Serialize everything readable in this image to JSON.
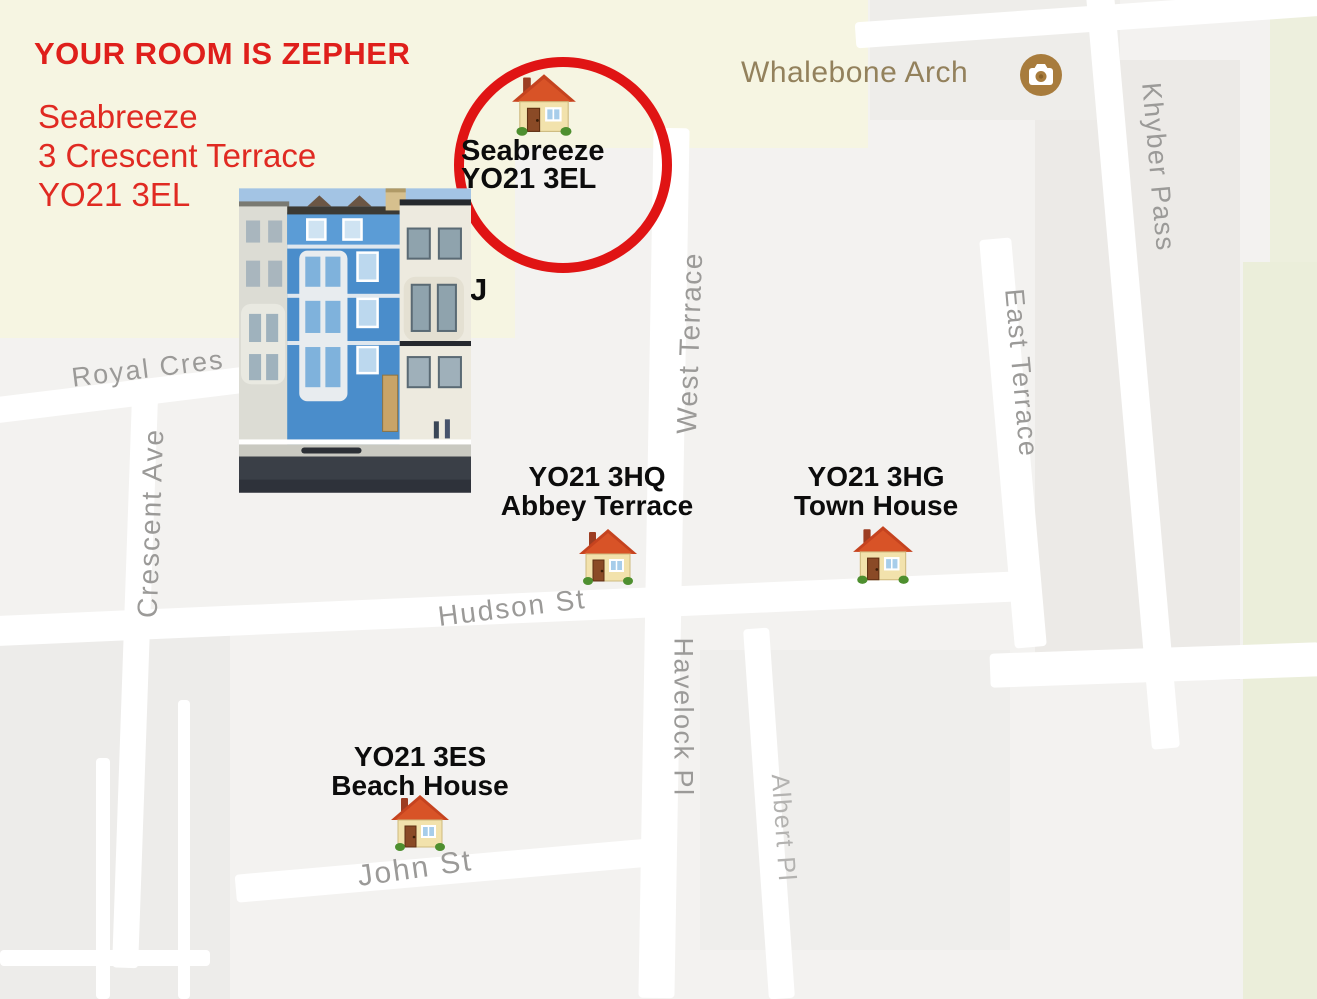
{
  "colors": {
    "annotation_red": "#e02420",
    "circle_red": "#e01414",
    "marker_text": "#0c0c0c",
    "street_label_gray": "#9b9a98",
    "poi_label_brown": "#93815c",
    "poi_icon_bg": "#a87c3d",
    "map_cream": "#f6f5e2",
    "map_green": "#ebeeda",
    "map_base": "#f3f2f0",
    "road_white": "#ffffff"
  },
  "icons": {
    "house": "house-icon",
    "camera": "camera-icon"
  },
  "annotations": {
    "headline": "YOUR ROOM IS ZEPHER",
    "address_line1": "Seabreeze",
    "address_line2": "3 Crescent Terrace",
    "address_line3": "YO21 3EL",
    "partial_label": "J"
  },
  "markers": {
    "seabreeze": {
      "name": "Seabreeze",
      "postcode": "YO21 3EL"
    },
    "abbey": {
      "postcode": "YO21 3HQ",
      "name": "Abbey Terrace"
    },
    "town": {
      "postcode": "YO21 3HG",
      "name": "Town House"
    },
    "beach": {
      "postcode": "YO21 3ES",
      "name": "Beach House"
    }
  },
  "poi": {
    "label": "Whalebone Arch"
  },
  "streets": {
    "royal_cres": "Royal Cres",
    "crescent_ave": "Crescent Ave",
    "west_terrace": "West Terrace",
    "east_terrace": "East Terrace",
    "khyber_pass": "Khyber Pass",
    "hudson_st": "Hudson St",
    "havelock_pl": "Havelock Pl",
    "albert_pl": "Albert Pl",
    "john_st": "John St"
  }
}
